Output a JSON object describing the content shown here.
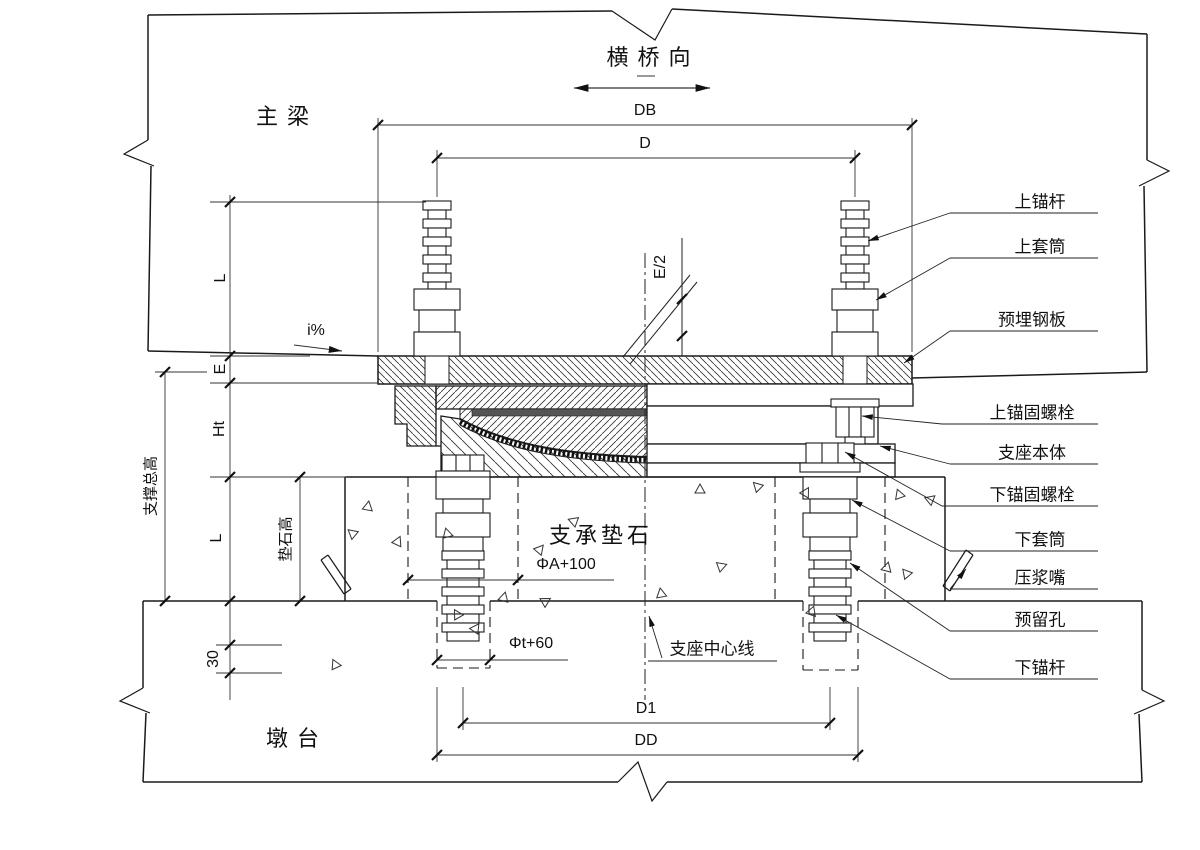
{
  "labels": {
    "direction": "横桥向",
    "main_girder": "主梁",
    "pier": "墩台",
    "pedestal": "支承垫石",
    "bearing_centerline": "支座中心线",
    "slope": "i%"
  },
  "dimensions": {
    "db": "DB",
    "d": "D",
    "d1": "D1",
    "dd": "DD",
    "e_half": "E/2",
    "l_upper": "L",
    "e": "E",
    "ht": "Ht",
    "l_lower": "L",
    "offset_bottom": "30",
    "support_total_height": "支撑总高",
    "pedestal_height": "垫石高",
    "upper_hole_dia": "ΦA+100",
    "lower_hole_dia": "Φt+60"
  },
  "callouts": [
    {
      "label": "上锚杆"
    },
    {
      "label": "上套筒"
    },
    {
      "label": "预埋钢板"
    },
    {
      "label": "上锚固螺栓"
    },
    {
      "label": "支座本体"
    },
    {
      "label": "下锚固螺栓"
    },
    {
      "label": "下套筒"
    },
    {
      "label": "压浆嘴"
    },
    {
      "label": "预留孔"
    },
    {
      "label": "下锚杆"
    }
  ],
  "colors": {
    "line": "#1a1a1a",
    "background": "#ffffff"
  }
}
